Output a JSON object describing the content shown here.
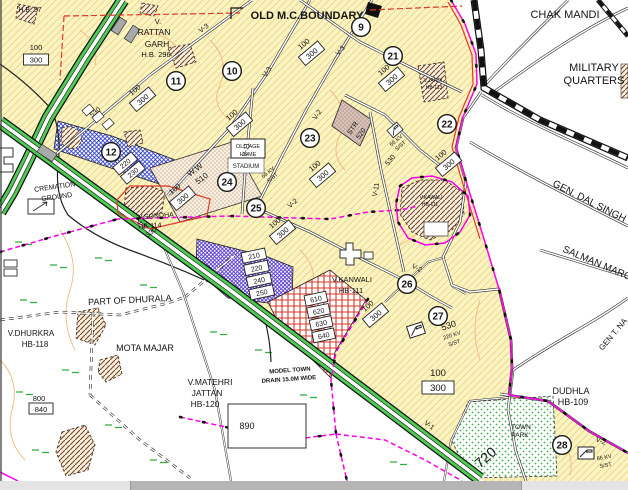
{
  "title": {
    "boundary": "OLD M.C.BOUNDARY",
    "hb57": "H.B. 57"
  },
  "places": {
    "chak_mandi": "CHAK MANDI",
    "military_1": "MILITARY",
    "military_2": "QUARTERS",
    "gen_dal_singh": "GEN. DAL SINGH",
    "salman_marg": "SALMAN MARG",
    "gen_t_na": "GEN T. NA",
    "dudhla_1": "DUDHLA",
    "dudhla_2": "HB-109",
    "town_park_1": "TOWN",
    "town_park_2": "PARK",
    "cremation_1": "CREMATION",
    "cremation_2": "GROUND",
    "part_of_dhurala": "PART OF DHURALA",
    "dhurkra_1": "V.DHURKRA",
    "dhurkra_2": "HB-118",
    "mota_majar": "MOTA MAJAR",
    "matehri_1": "V.MATEHRI",
    "matehri_2": "JATTAN",
    "matehri_3": "HB-120",
    "drain_1": "MODEL TOWN",
    "drain_2": "DRAIN 15.0M WIDE",
    "sondha_1": "V.SONDHA",
    "sondha_2": "HB-114",
    "kanwali_1": "V.KANWALI",
    "kanwali_2": "HB-111",
    "kawali_1": "V.KAWALI",
    "kawali_2": "HB-111",
    "jandi_1": "V.JANDI",
    "jandi_2": "HB-113",
    "rattan_1": "V.",
    "rattan_2": "RATTAN",
    "rattan_3": "GARH",
    "rattan_4": "H.B. 296",
    "old_age_1": "OLD AGE",
    "old_age_2": "HOME",
    "stadium": "STADIUM"
  },
  "circles": [
    "9",
    "10",
    "11",
    "12",
    "21",
    "22",
    "23",
    "24",
    "25",
    "26",
    "27",
    "28"
  ],
  "roads": {
    "v1": "V-1",
    "v2": "V-2",
    "v3": "V-3",
    "v11": "V-11"
  },
  "plots": {
    "p100": "100",
    "p300": "300",
    "p220": "220",
    "p230": "230",
    "p210": "210",
    "p240": "240",
    "p250": "250",
    "p610": "610",
    "p620": "620",
    "p630": "630",
    "p640": "640",
    "p800": "800",
    "p840": "840",
    "p890": "890",
    "p720": "720",
    "p510": "510",
    "p520": "520",
    "p530": "530",
    "p330": "330",
    "ww": "W.W",
    "str": "STR",
    "kv220": "220 KV",
    "kv66": "66 KV",
    "sst": "S/ST"
  },
  "colors": {
    "map_yellow": "#FCF3C3",
    "yellow_hatch": "#EAD67E",
    "zone_blue": "#2433C8",
    "zone_purple": "#4B2FD0",
    "zone_red": "#D43A2A",
    "road_green": "#4ECB52",
    "boundary_magenta": "#FF00E6",
    "village_brown": "#7A4526",
    "park_green": "#2FAE3E",
    "red_line": "#E2392A"
  },
  "scrollbar": {
    "orientation": "horizontal"
  }
}
